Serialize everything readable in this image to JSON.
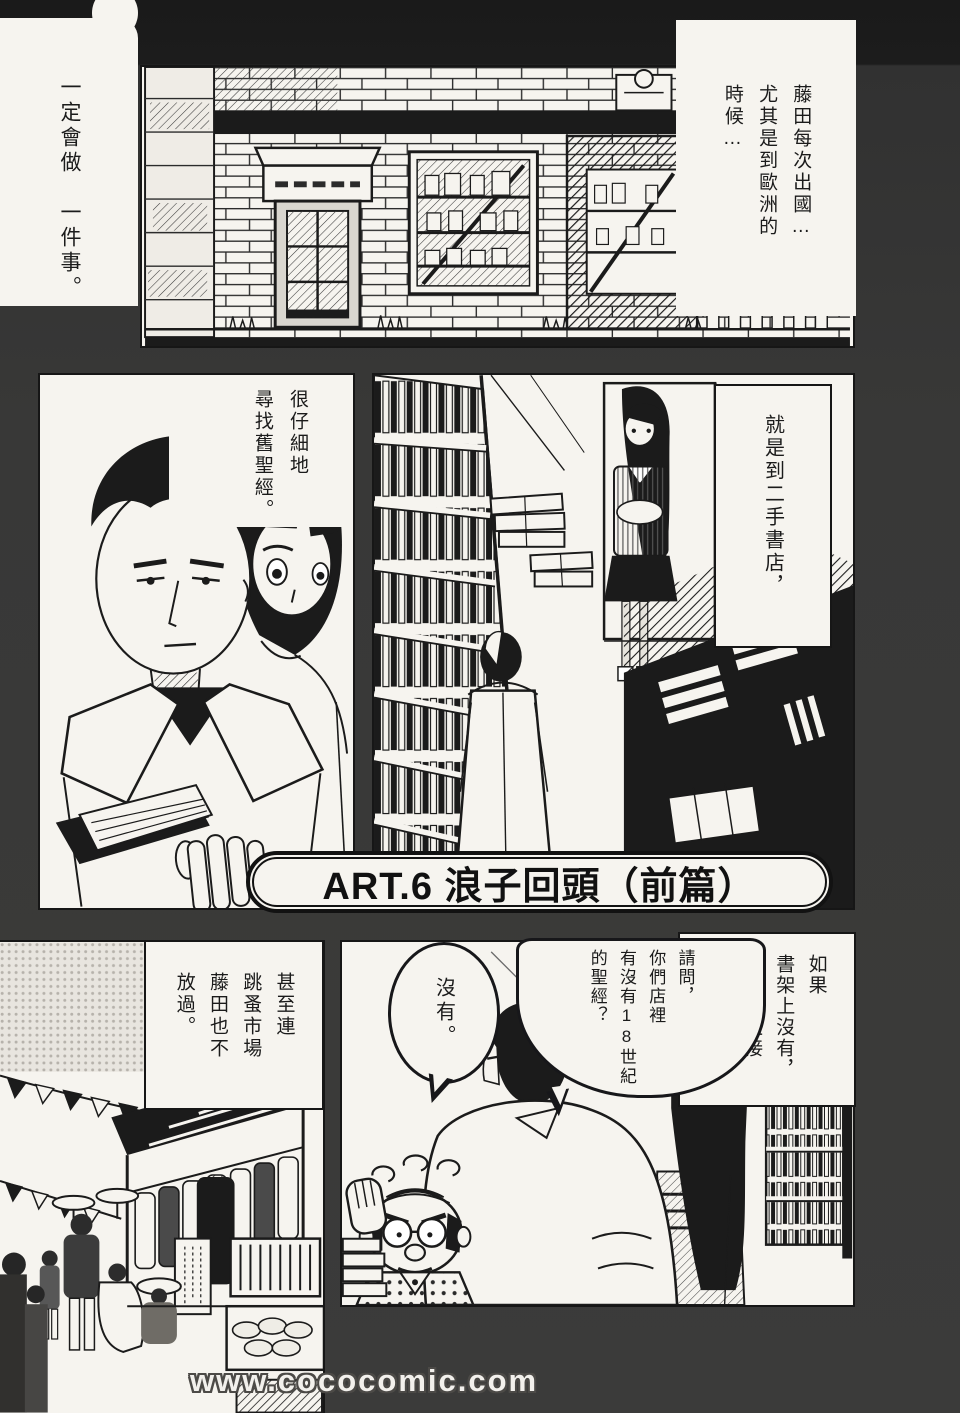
{
  "page": {
    "title_banner": "ART.6 浪子回頭（前篇）",
    "watermark": "www.cococomic.com"
  },
  "captions": {
    "top_left": "一定會做　一件事。",
    "top_right": "藤田每次出國…\n尤其是到歐洲的\n時候…",
    "mid_left": "很仔細地\n尋找舊聖經。",
    "mid_right": "就是到二手書店，",
    "bottom_right": "如果\n書架上沒有，\n他還會直接\n去問店老闆。",
    "bottom_left": "甚至連\n跳蚤市場\n藤田也不\n放過。"
  },
  "bubbles": {
    "question": "請問，\n你們店裡\n有沒有18世紀\n的聖經？",
    "answer": "沒有。"
  },
  "panels": {
    "storefront": "used bookstore exterior with brick wall, awning door and display window",
    "reading_closeup": "man in white coat reading an old book, woman behind him",
    "bookstore_interior": "tall bookshelves, woman at door, man browsing stacks",
    "flea_market": "street market with pennants, stalls, hanging clothes and crates",
    "shop_conversation": "customer asking old shopkeeper, woman and bookshelf at right"
  },
  "colors": {
    "page_background": "#3b3b3a",
    "paper": "#f6f4ef",
    "ink": "#1b1b1b"
  }
}
